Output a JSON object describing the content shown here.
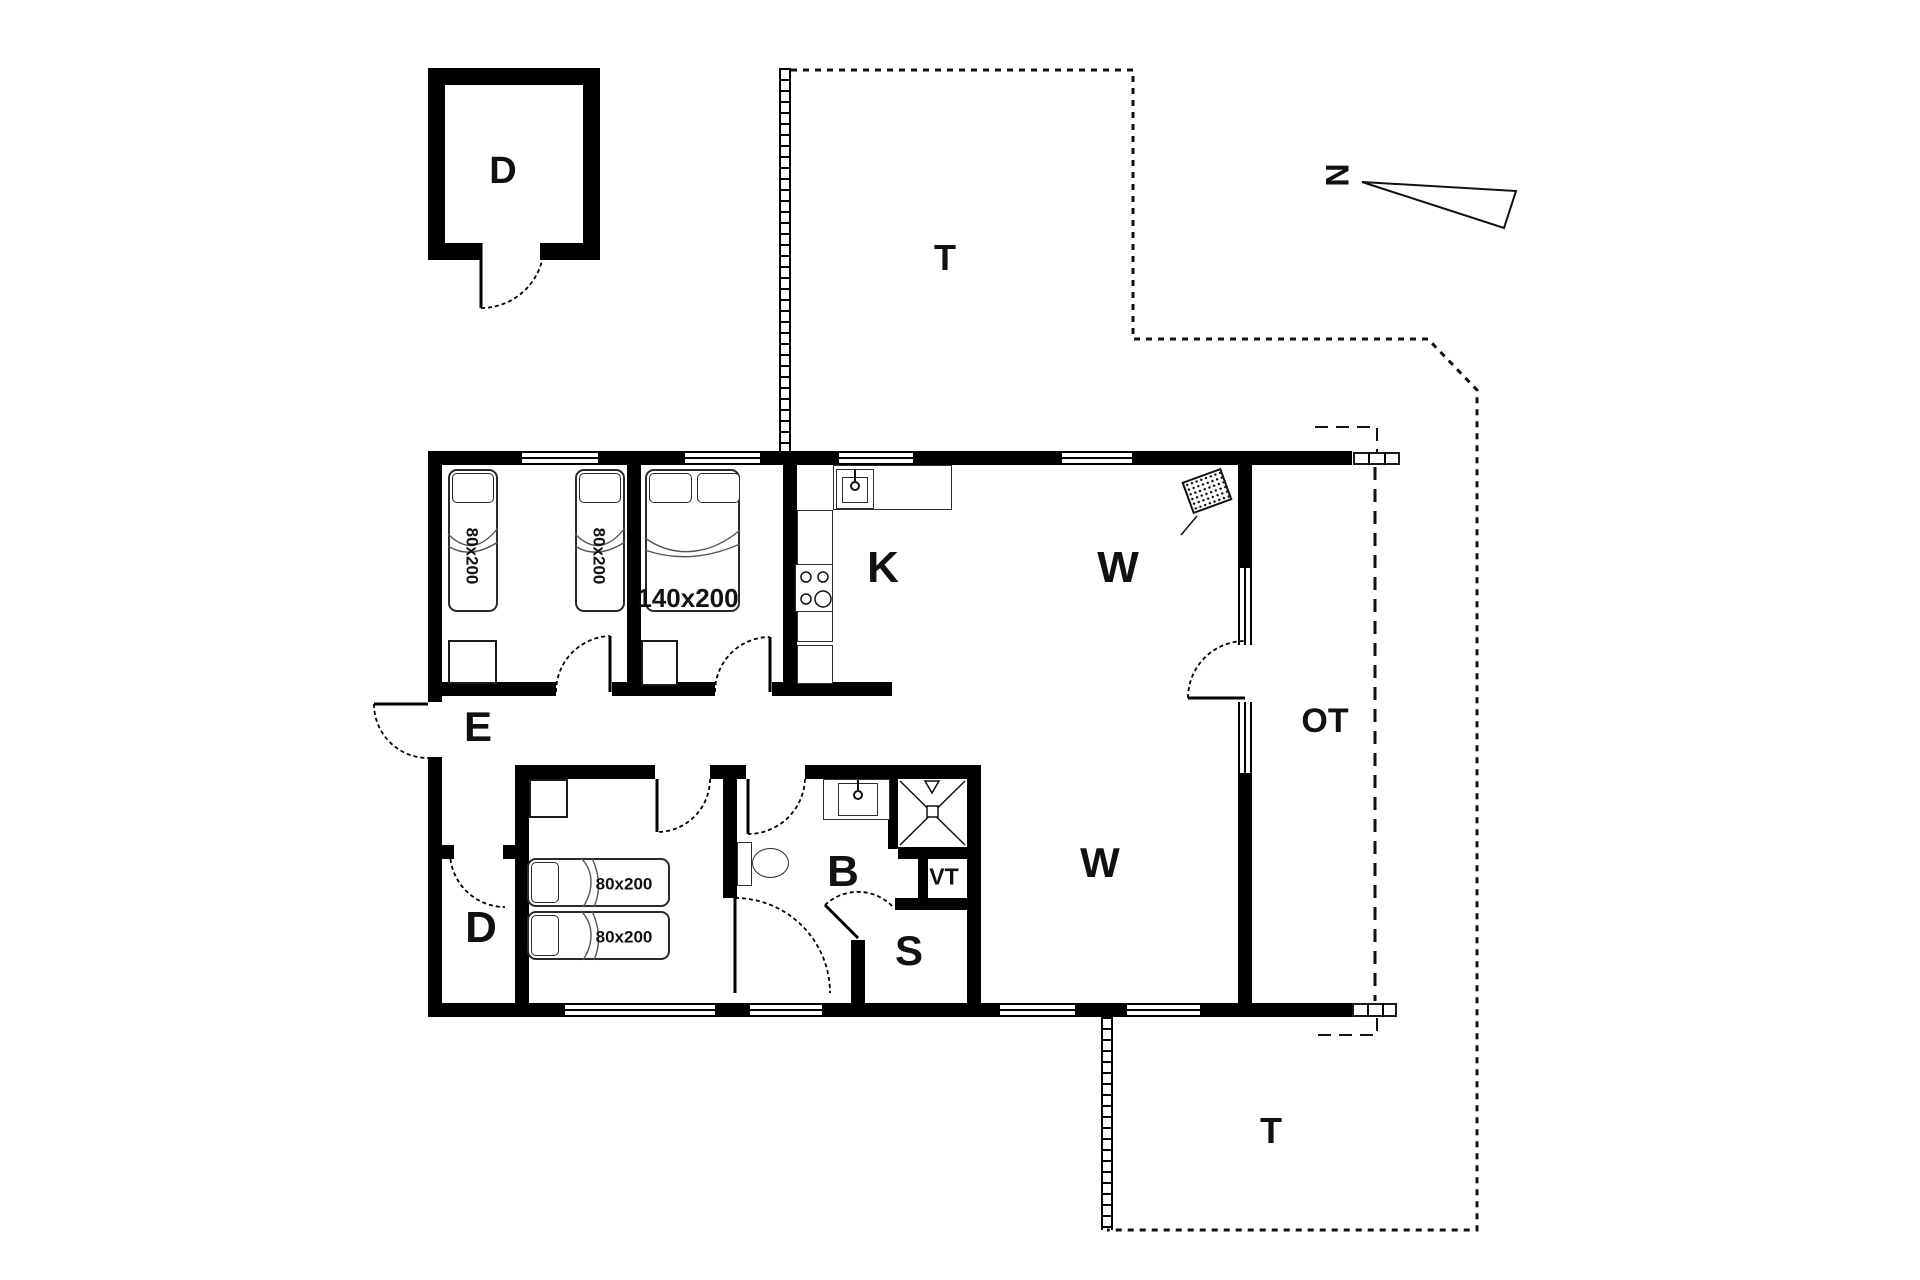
{
  "colors": {
    "wall": "#000000",
    "background": "#ffffff",
    "line": "#222222"
  },
  "labels": {
    "outbuilding": "D",
    "terrace_top": "T",
    "terrace_bottom": "T",
    "covered_terrace": "OT",
    "north": "N",
    "entrance": "E",
    "storage": "D",
    "kitchen": "K",
    "living_north": "W",
    "living_south": "W",
    "bathroom": "B",
    "sauna": "S",
    "utility": "VT"
  },
  "beds": {
    "bedroom1_bed1": "80x200",
    "bedroom1_bed2": "80x200",
    "bedroom2_double": "140x200",
    "bedroom3_bed1": "80x200",
    "bedroom3_bed2": "80x200"
  }
}
